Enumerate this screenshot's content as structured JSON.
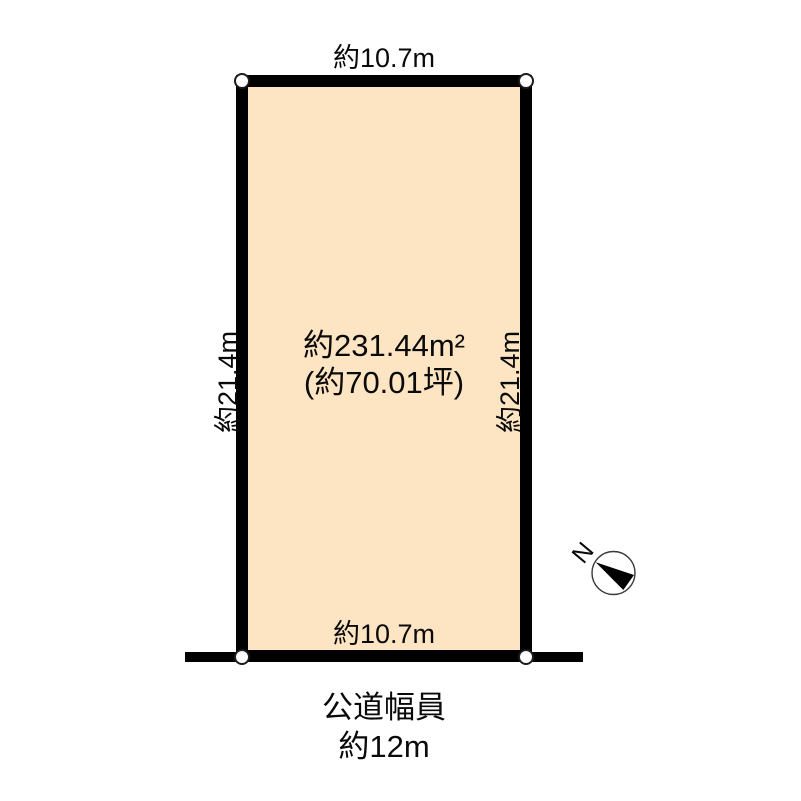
{
  "plot": {
    "top_length": "約10.7m",
    "bottom_length": "約10.7m",
    "left_length": "約21.4m",
    "right_length": "約21.4m",
    "area_sqm": "約231.44m²",
    "area_tsubo": "(約70.01坪)",
    "fill_color": "#FDE4C2",
    "outline_color": "#000000"
  },
  "road": {
    "line1": "公道幅員",
    "line2": "約12m"
  },
  "compass": {
    "north_label": "N"
  }
}
